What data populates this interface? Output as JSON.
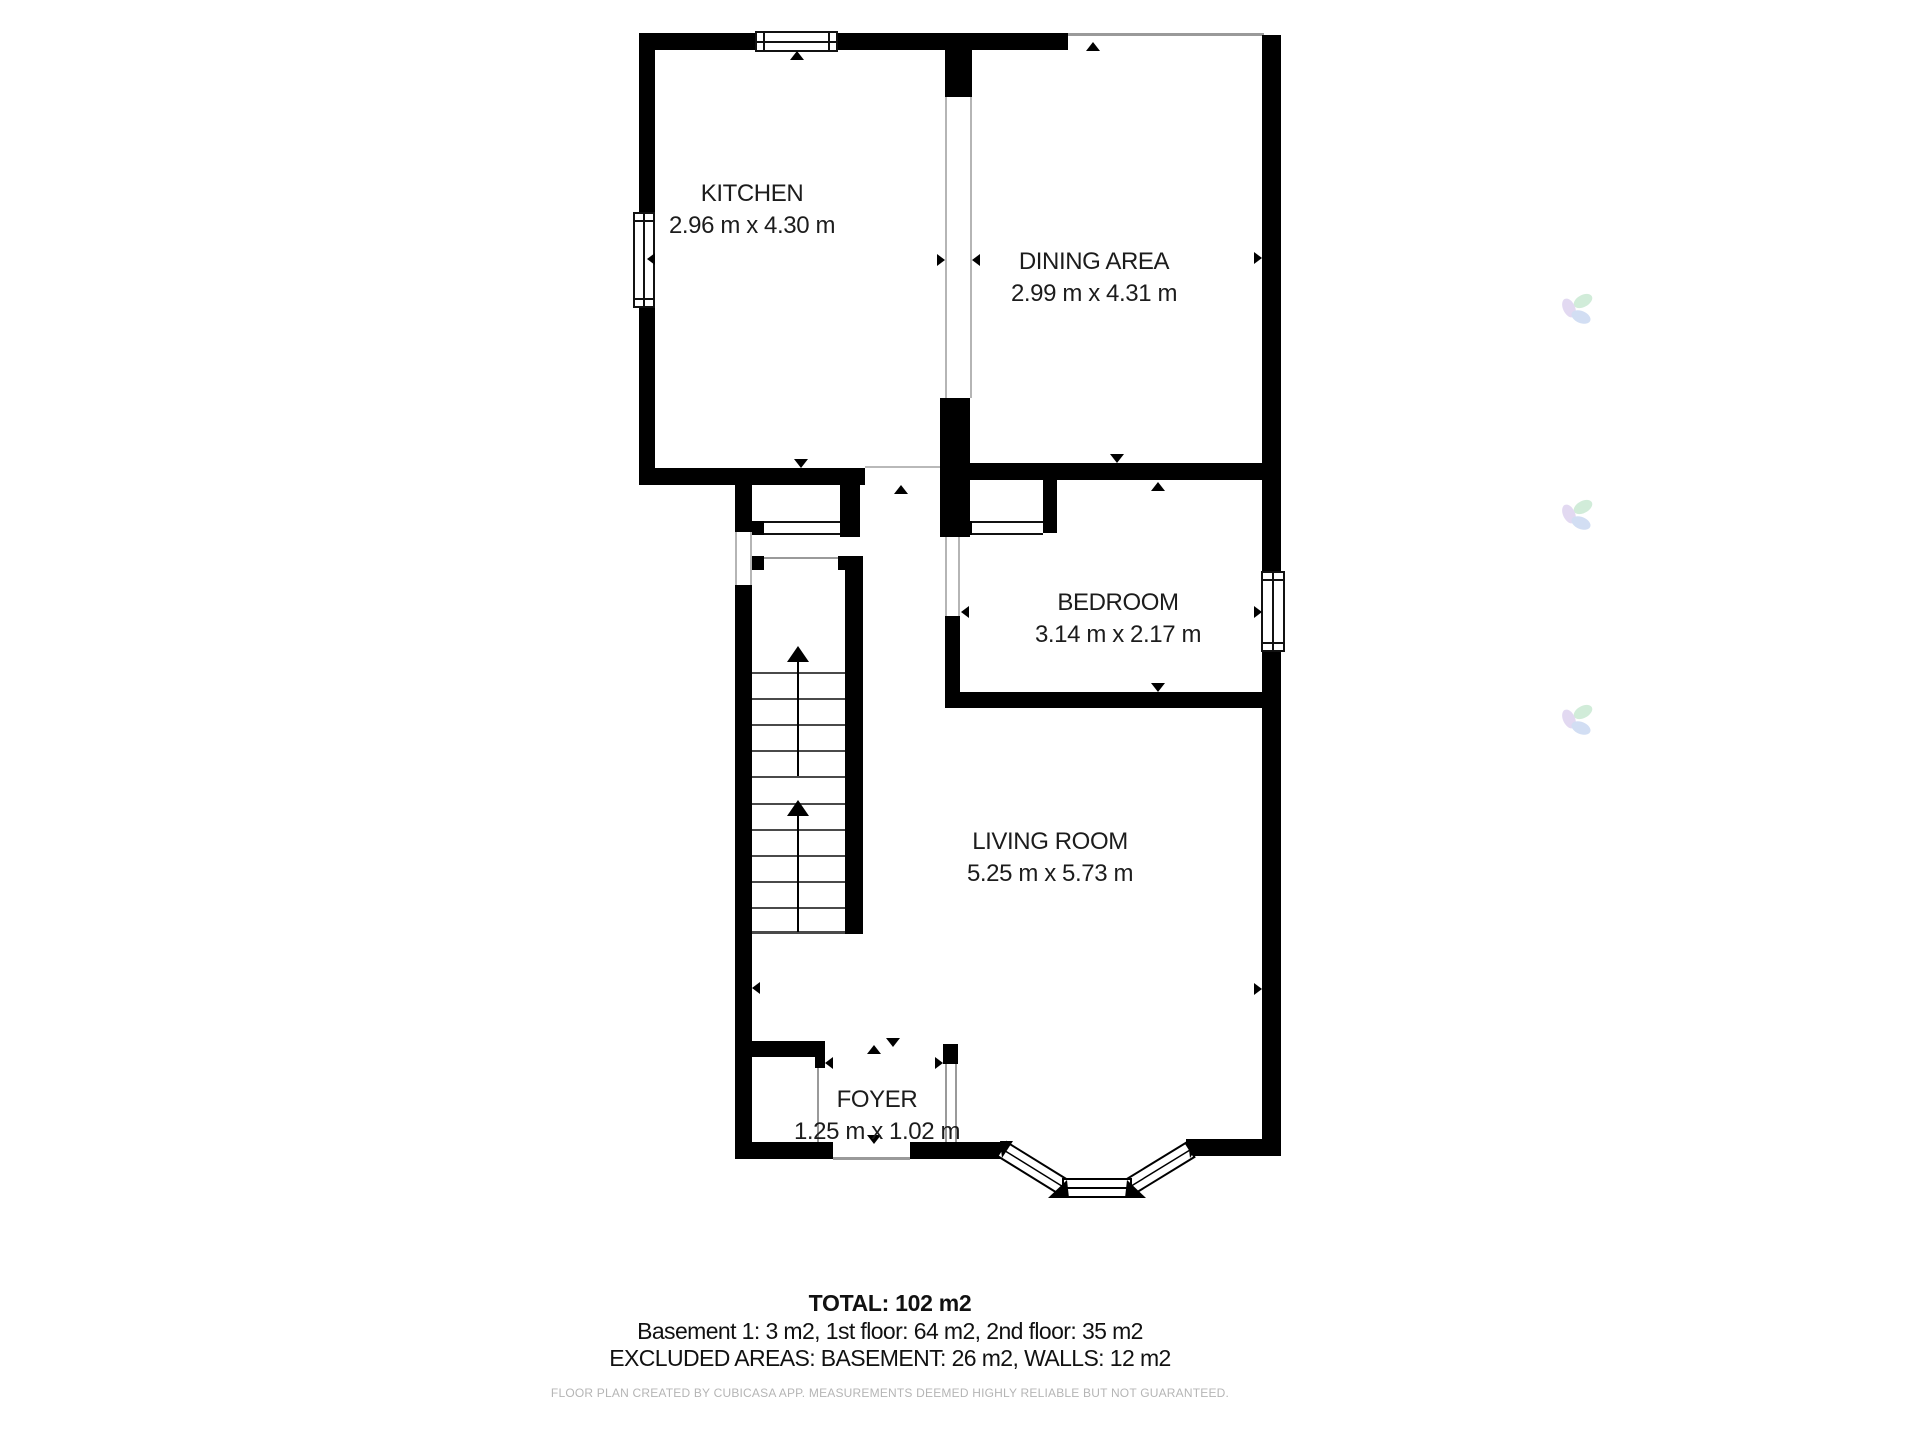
{
  "rooms": [
    {
      "name": "KITCHEN",
      "dims": "2.96 m x 4.30 m"
    },
    {
      "name": "DINING AREA",
      "dims": "2.99 m x 4.31 m"
    },
    {
      "name": "BEDROOM",
      "dims": "3.14 m x 2.17 m"
    },
    {
      "name": "LIVING ROOM",
      "dims": "5.25 m x 5.73 m"
    },
    {
      "name": "FOYER",
      "dims": "1.25 m x 1.02 m"
    }
  ],
  "summary": {
    "total": "TOTAL: 102 m2",
    "floors": "Basement 1: 3 m2, 1st floor: 64 m2, 2nd floor: 35 m2",
    "excluded": "EXCLUDED AREAS: BASEMENT: 26 m2, WALLS: 12 m2",
    "disclaimer": "FLOOR PLAN CREATED BY CUBICASA APP. MEASUREMENTS DEEMED HIGHLY RELIABLE BUT NOT GUARANTEED."
  },
  "colors": {
    "wall": "#000000",
    "label_text": "#1c1c1c",
    "disclaimer_text": "#b5b5b5",
    "thin_line": "#9a9a9a",
    "watermark_green": "#c9e9d3",
    "watermark_purple": "#ded3ef",
    "watermark_blue": "#cbd9f1"
  }
}
